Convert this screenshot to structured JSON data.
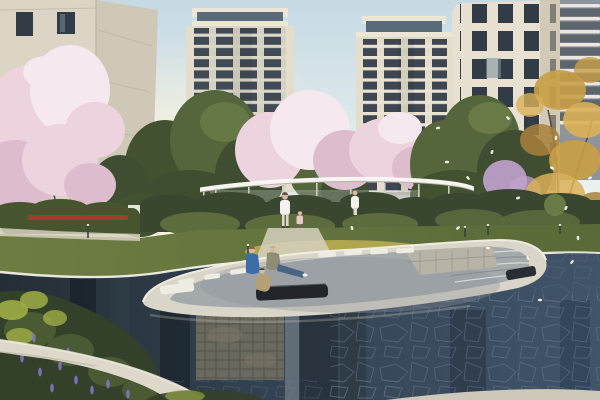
{
  "scene": {
    "domain": "natural-image",
    "description": "Photorealistic architectural rendering of a residential community: twin cream high-rise towers with dark window bands, a close cream building on each side, pink cherry-blossom trees, green and autumn-gold trees, a thin white flat-roof pavilion over hedges, a lawn, and a dark reflecting pool containing a sunken white lounge island with bench cushions and stone steps; falling petals drift on the right.",
    "people": [
      {
        "id": "sitting-adult-blue",
        "pose": "seated",
        "clothing": "blue shirt"
      },
      {
        "id": "sitting-adult-tan",
        "pose": "seated, legs stretched",
        "clothing": "tan top, jeans, white shoes"
      },
      {
        "id": "sitting-child",
        "pose": "crouching below bench",
        "clothing": "khaki"
      },
      {
        "id": "walking-woman",
        "pose": "walking on path",
        "clothing": "white"
      },
      {
        "id": "walking-child",
        "pose": "walking beside woman",
        "clothing": "pink"
      },
      {
        "id": "pavilion-woman",
        "pose": "standing near pavilion",
        "clothing": "white"
      }
    ]
  },
  "palette": {
    "skyTop": "#c6dae4",
    "skyMid": "#edf2ef",
    "skyHorizon": "#f7efda",
    "glow": "#fff3d8",
    "towerCream": "#ddd6c4",
    "towerCreamLight": "#ece6d6",
    "towerPier": "#e4ddcb",
    "towerWin": "#3e4651",
    "towerGlass": "#5b6a78",
    "towerSlab": "#eae4d3",
    "bldgRightLit": "#e8e1d1",
    "bldgRightShade": "#c0b7a2",
    "bldgWin": "#323c46",
    "bldgWinLit": "#7e929f",
    "bldgLeftFront": "#dcd5c5",
    "bldgLeftSide": "#cfc8b6",
    "seam": "#bdb5a2",
    "distantTower": "#8d949c",
    "distantBand": "#e9e7df",
    "distantWin": "#4d565e",
    "treeGreenDark": "#42512f",
    "treeGreen": "#55663c",
    "treeGreenLight": "#6e8049",
    "treeOlive": "#3f4e30",
    "blossom": "#ecd3de",
    "blossomLight": "#f6e8ef",
    "blossomShade": "#ddbccd",
    "blossomPurple": "#c2a3cf",
    "autumn": "#c99f45",
    "autumnLight": "#dab057",
    "autumnDark": "#a8813c",
    "branch": "#5d4b38",
    "pavilionRoof": "#f6f4ee",
    "pavilionShadow": "#a8a69b",
    "pavilionCol": "#cfccc0",
    "pavilionGlass": "#c6d2d4",
    "hedgeDark": "#3a4730",
    "hedge": "#47552f",
    "hedgeLight": "#5d6c3d",
    "redFlowers": "#a63c2f",
    "grass": "#6d7d42",
    "grassRight": "#5a6a38",
    "grassSun": "#b8ad52",
    "pathLight": "#d6d0be",
    "waterDark": "#242e35",
    "waterMid": "#334252",
    "waterBlue": "#41546a",
    "waterHighlight": "#98a0a2",
    "coping": "#d9d5c8",
    "copingBright": "#f2efe6",
    "paving": "#a4a9ac",
    "stepLight": "#d6dadd",
    "stepShade": "#80888e",
    "stoneSeat": "#b7b3a6",
    "stoneJoint": "#8f8b7d",
    "cushion": "#efede2",
    "sofaDark": "#22262b",
    "stoneWall": "#6f6d5f",
    "stoneWallJoint": "#524f44",
    "flagstone": "#6c7f93",
    "skinTone": "#d9b9a4",
    "shirtBlue": "#3c6ea5",
    "shirtTan": "#8e8c74",
    "jeans": "#4a6584",
    "outfitWhite": "#f4f2ec",
    "childPink": "#e7c9c6",
    "childKhaki": "#b3a077",
    "hairRed": "#9a5c42",
    "hairBrown": "#6b5342",
    "hairBlond": "#c9b08a",
    "hairDark": "#4a3b30",
    "shrubFg": "#33402a",
    "shrubFgLight": "#4a5a33",
    "shrubYellow": "#9fae45",
    "flowerPurple": "#8177c0",
    "fgPath": "#ddd8ca",
    "fgPathShade": "#b8b2a2",
    "petal": "#f6f2e8",
    "bollard": "#3a3f42",
    "bollardTop": "#f5ead0",
    "bottomEdge": "#cdc8b9"
  },
  "petals": [
    [
      447,
      162
    ],
    [
      468,
      178
    ],
    [
      492,
      152
    ],
    [
      518,
      198
    ],
    [
      552,
      168
    ],
    [
      578,
      238
    ],
    [
      458,
      228
    ],
    [
      488,
      248
    ],
    [
      528,
      258
    ],
    [
      566,
      208
    ],
    [
      438,
      128
    ],
    [
      508,
      118
    ],
    [
      556,
      138
    ],
    [
      590,
      178
    ],
    [
      412,
      246
    ],
    [
      352,
      228
    ],
    [
      572,
      262
    ],
    [
      540,
      300
    ]
  ],
  "bollards": [
    [
      88,
      224,
      14
    ],
    [
      248,
      244,
      16
    ],
    [
      465,
      226,
      11
    ],
    [
      488,
      224,
      11
    ],
    [
      560,
      224,
      10
    ]
  ],
  "flowers": [
    [
      34,
      338
    ],
    [
      46,
      352
    ],
    [
      60,
      366
    ],
    [
      76,
      380
    ],
    [
      92,
      390
    ],
    [
      22,
      358
    ],
    [
      108,
      384
    ],
    [
      128,
      394
    ],
    [
      52,
      388
    ],
    [
      68,
      352
    ],
    [
      40,
      372
    ],
    [
      112,
      368
    ]
  ]
}
